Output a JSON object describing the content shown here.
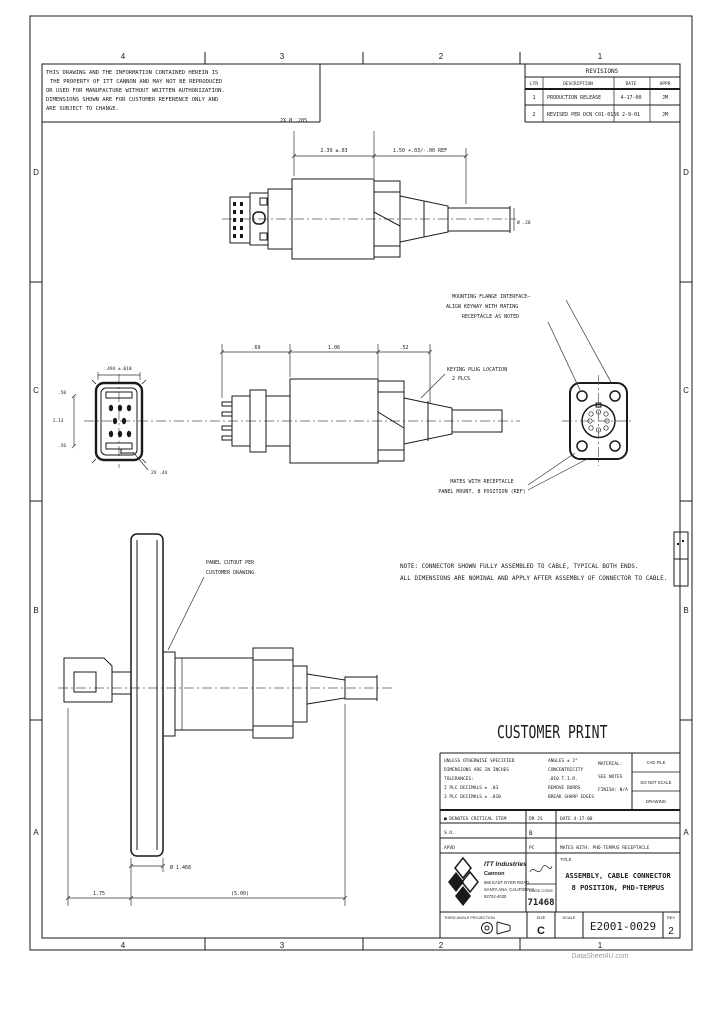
{
  "colors": {
    "ink": "#1a1a1a",
    "paper": "#ffffff",
    "faint": "#9a9a9a"
  },
  "sheet": {
    "zones_top": [
      "4",
      "3",
      "2",
      "1"
    ],
    "zones_bottom": [
      "4",
      "3",
      "2",
      "1"
    ],
    "zones_left": [
      "D",
      "C",
      "B",
      "A"
    ],
    "zones_right": [
      "D",
      "C",
      "B",
      "A"
    ]
  },
  "proprietary_note": {
    "lines": [
      "THIS DRAWING AND THE INFORMATION CONTAINED HEREIN IS",
      "THE PROPERTY OF ITT CANNON AND MAY NOT BE REPRODUCED",
      "OR USED FOR MANUFACTURE WITHOUT WRITTEN AUTHORIZATION.",
      "DIMENSIONS SHOWN ARE FOR CUSTOMER REFERENCE ONLY AND",
      "ARE SUBJECT TO CHANGE."
    ]
  },
  "revisions": {
    "title": "REVISIONS",
    "headers": [
      "LTR",
      "DESCRIPTION",
      "DATE",
      "APPR"
    ],
    "rows": [
      {
        "ltr": "1",
        "description": "PRODUCTION RELEASE",
        "date": "4-17-00",
        "appr": "JM"
      },
      {
        "ltr": "2",
        "description": "REVISED PER DCN C01-0156",
        "date": "2-9-01",
        "appr": "JM"
      }
    ]
  },
  "top_view": {
    "hole_callout": "2X Ø .205",
    "dim_a": "2.39 ±.03",
    "dim_b": "1.50 +.03/-.00 REF",
    "cable_dim": "Ø .28"
  },
  "middle_view": {
    "dim_1": ".69",
    "dim_2": "1.06",
    "dim_3": ".52",
    "face_dim_width": ".494 ±.010",
    "face_dim_top": ".50",
    "face_dim_height": "1.13",
    "face_dim_bot": ".56",
    "face_dim_latch": "2X .44",
    "keying_callout": [
      "KEYING PLUG LOCATION",
      "2 PLCS"
    ],
    "flange_callout": [
      "MOUNTING FLANGE INTERFACE—",
      "ALIGN KEYWAY WITH MATING",
      "RECEPTACLE AS NOTED"
    ],
    "mating_callout": [
      "MATES WITH RECEPTACLE",
      "PANEL MOUNT, 8 POSITION (REF)"
    ]
  },
  "bottom_view": {
    "panel_callout": [
      "PANEL CUTOUT PER",
      "CUSTOMER DRAWING"
    ],
    "dim_flange": "Ø 1.468",
    "dim_left": "1.75",
    "dim_length": "(5.00)"
  },
  "general_notes": {
    "lines": [
      "NOTE: CONNECTOR SHOWN FULLY ASSEMBLED TO CABLE, TYPICAL BOTH ENDS.",
      "ALL DIMENSIONS ARE NOMINAL AND APPLY AFTER ASSEMBLY OF CONNECTOR TO CABLE."
    ]
  },
  "customer_print": "CUSTOMER PRINT",
  "title_block": {
    "tol_left": {
      "lines": [
        "UNLESS OTHERWISE SPECIFIED",
        "DIMENSIONS ARE IN INCHES",
        "TOLERANCES:",
        "2 PLC DECIMALS  ± .03",
        "3 PLC DECIMALS  ± .010"
      ]
    },
    "tol_mid": {
      "lines": [
        "ANGLES ± 2°",
        "CONCENTRICITY",
        ".010 T.I.R.",
        "REMOVE BURRS",
        "BREAK SHARP EDGES"
      ]
    },
    "material": {
      "lines": [
        "MATERIAL:",
        "SEE NOTES",
        "FINISH: N/A"
      ]
    },
    "side_cells": [
      "CAD FILE",
      "DO NOT SCALE",
      "DRAWING"
    ],
    "row1": {
      "c1": "■ DENOTES CRITICAL ITEM",
      "c2": "DR JS",
      "c3": "DATE  4-17-00"
    },
    "row2": {
      "c1": "S.O.",
      "c2": "B",
      "c3": ""
    },
    "row3": {
      "c1": "APVD",
      "c2": "PC",
      "c3": "MATES WITH:  PHD-TEMPUS RECEPTACLE"
    },
    "company": {
      "lines": [
        "ITT Industries",
        "Cannon",
        "666 EAST DYER ROAD",
        "SANTA ANA, CALIFORNIA",
        "92702-4030"
      ]
    },
    "cage_label": "CAGE CODE",
    "cage_code": "71468",
    "title_label": "TITLE",
    "title_lines": [
      "ASSEMBLY, CABLE CONNECTOR",
      "8 POSITION, PHD-TEMPUS"
    ],
    "projection_label": "THIRD ANGLE PROJECTION",
    "size_label": "SIZE",
    "size": "C",
    "scale_label": "SCALE",
    "scale": "",
    "dwg_no": "E2001-0029",
    "rev_label": "REV",
    "rev": "2"
  },
  "watermark": "DataSheet4U.com"
}
